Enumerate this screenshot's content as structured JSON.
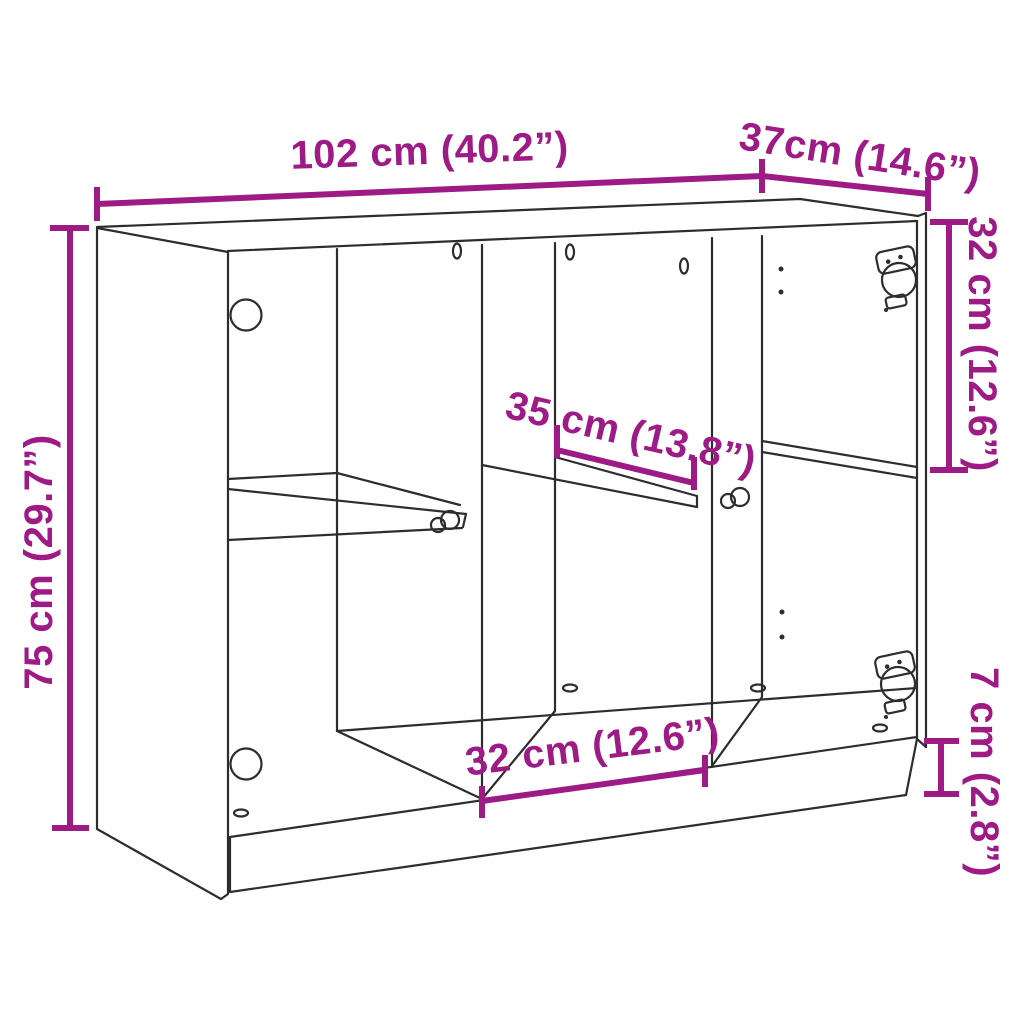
{
  "title": "Sideboard dimension diagram",
  "figure": {
    "type": "furniture-dimension-diagram",
    "item": "sideboard with open glass doors, two dividers, shelves and plinth base"
  },
  "colors": {
    "accent_magenta": "#9e1b86",
    "line_ink": "#2d2d2d",
    "background": "#ffffff"
  },
  "labels": {
    "width": "102 cm (40.2”)",
    "depth": "37cm (14.6”)",
    "height": "75 cm (29.7”)",
    "top_section_height": "32 cm (12.6”)",
    "middle_shelf_width": "35 cm (13.8”)",
    "bottom_section_width": "32 cm (12.6”)",
    "plinth_height": "7 cm (2.8”)"
  }
}
